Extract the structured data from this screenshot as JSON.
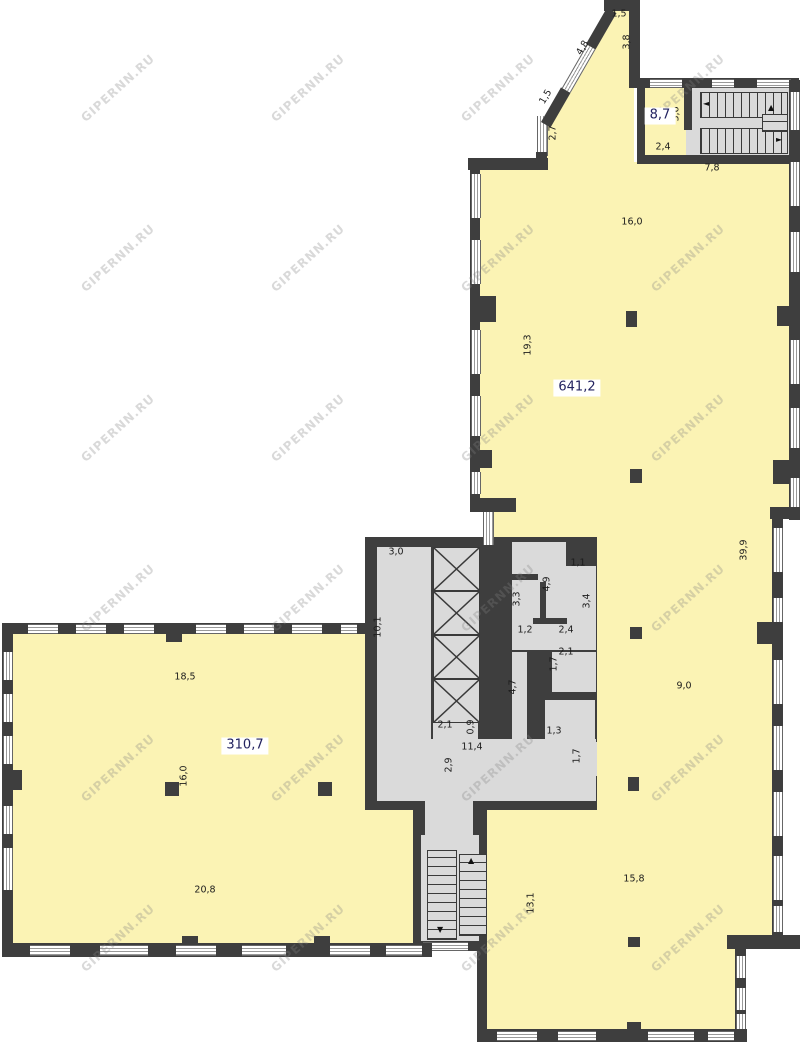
{
  "colors": {
    "room_fill": "#FBF3B4",
    "wall": "#3E3E3E",
    "floor_gray": "#DADADA",
    "dim_text": "#1C1C1C",
    "area_label_text": "#232360"
  },
  "watermark": {
    "text": "GIPERNN.RU",
    "cols": [
      118,
      308,
      498,
      688
    ],
    "rows": [
      88,
      258,
      428,
      598,
      768,
      938
    ]
  },
  "icons": {
    "up_arrow": "▲",
    "down_arrow": "▼",
    "left_arrow": "◄",
    "right_arrow": "►"
  },
  "area_labels": [
    {
      "text": "8,7",
      "x": 660,
      "y": 116
    },
    {
      "text": "641,2",
      "x": 577,
      "y": 388
    },
    {
      "text": "310,7",
      "x": 245,
      "y": 746
    }
  ],
  "dimensions": [
    {
      "text": "1,5",
      "x": 619,
      "y": 14,
      "rot": 0
    },
    {
      "text": "3,8",
      "x": 627,
      "y": 42,
      "rot": -90
    },
    {
      "text": "4,8",
      "x": 583,
      "y": 48,
      "rot": -60
    },
    {
      "text": "1,5",
      "x": 546,
      "y": 97,
      "rot": -60
    },
    {
      "text": "2,7",
      "x": 553,
      "y": 133,
      "rot": -90
    },
    {
      "text": "3,6",
      "x": 676,
      "y": 114,
      "rot": -90
    },
    {
      "text": "2,4",
      "x": 663,
      "y": 147,
      "rot": 0
    },
    {
      "text": "7,8",
      "x": 712,
      "y": 168,
      "rot": 0
    },
    {
      "text": "16,0",
      "x": 632,
      "y": 222,
      "rot": 0
    },
    {
      "text": "19,3",
      "x": 528,
      "y": 345,
      "rot": -90
    },
    {
      "text": "39,9",
      "x": 744,
      "y": 550,
      "rot": -90
    },
    {
      "text": "9,0",
      "x": 684,
      "y": 686,
      "rot": 0
    },
    {
      "text": "15,8",
      "x": 634,
      "y": 879,
      "rot": 0
    },
    {
      "text": "13,1",
      "x": 531,
      "y": 903,
      "rot": -90
    },
    {
      "text": "3,0",
      "x": 396,
      "y": 552,
      "rot": 0
    },
    {
      "text": "10,1",
      "x": 378,
      "y": 627,
      "rot": -90
    },
    {
      "text": "3,3",
      "x": 517,
      "y": 599,
      "rot": -90
    },
    {
      "text": "4,9",
      "x": 547,
      "y": 584,
      "rot": -90
    },
    {
      "text": "1,1",
      "x": 578,
      "y": 563,
      "rot": 0
    },
    {
      "text": "3,4",
      "x": 587,
      "y": 601,
      "rot": -90
    },
    {
      "text": "1,2",
      "x": 525,
      "y": 630,
      "rot": 0
    },
    {
      "text": "2,4",
      "x": 566,
      "y": 630,
      "rot": 0
    },
    {
      "text": "2,1",
      "x": 566,
      "y": 652,
      "rot": 0
    },
    {
      "text": "1,7",
      "x": 554,
      "y": 664,
      "rot": -90
    },
    {
      "text": "2,1",
      "x": 445,
      "y": 725,
      "rot": 0
    },
    {
      "text": "0,9",
      "x": 471,
      "y": 727,
      "rot": -90
    },
    {
      "text": "4,7",
      "x": 513,
      "y": 687,
      "rot": -90
    },
    {
      "text": "1,3",
      "x": 554,
      "y": 731,
      "rot": 0
    },
    {
      "text": "11,4",
      "x": 472,
      "y": 747,
      "rot": 0
    },
    {
      "text": "2,9",
      "x": 449,
      "y": 765,
      "rot": -90
    },
    {
      "text": "1,7",
      "x": 577,
      "y": 756,
      "rot": -90
    },
    {
      "text": "18,5",
      "x": 185,
      "y": 677,
      "rot": 0
    },
    {
      "text": "16,0",
      "x": 184,
      "y": 776,
      "rot": -90
    },
    {
      "text": "20,8",
      "x": 205,
      "y": 890,
      "rot": 0
    }
  ]
}
